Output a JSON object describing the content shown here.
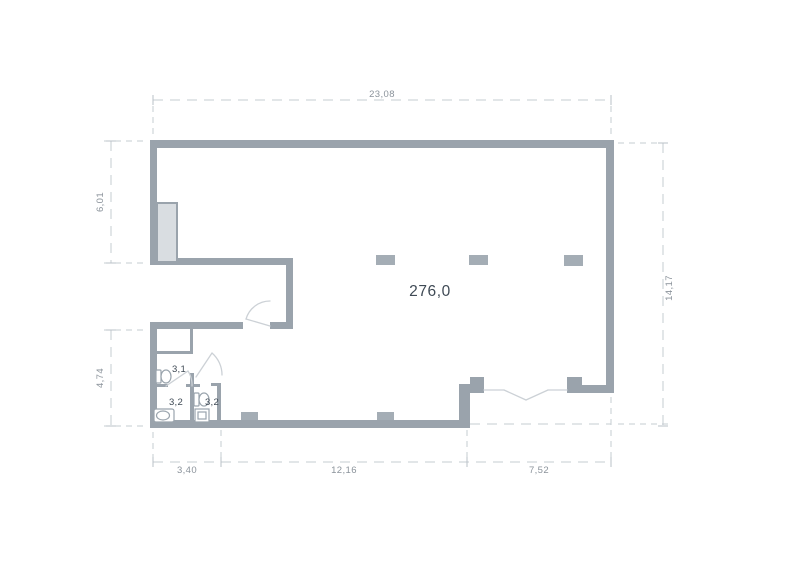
{
  "plan": {
    "area_label": "276,0",
    "rooms": [
      {
        "label": "3,1"
      },
      {
        "label": "3,2"
      },
      {
        "label": "3,2"
      }
    ],
    "dimensions": {
      "top": "23,08",
      "left_upper": "6,01",
      "left_lower": "4,74",
      "right": "14,17",
      "bottom_left": "3,40",
      "bottom_middle": "12,16",
      "bottom_right": "7,52"
    },
    "fixtures": [
      "toilet",
      "toilet",
      "bathtub",
      "sink"
    ],
    "colors": {
      "wall": "#9aa3ac",
      "shaft_fill": "#d9dde1",
      "pillar": "#a4adb5",
      "dim_line": "#c6ccd2",
      "dim_text": "#8b939b",
      "label_text": "#3f4a55",
      "fixture_line": "#9aa4ad",
      "door_line": "#ccd1d6",
      "background": "#ffffff"
    }
  }
}
